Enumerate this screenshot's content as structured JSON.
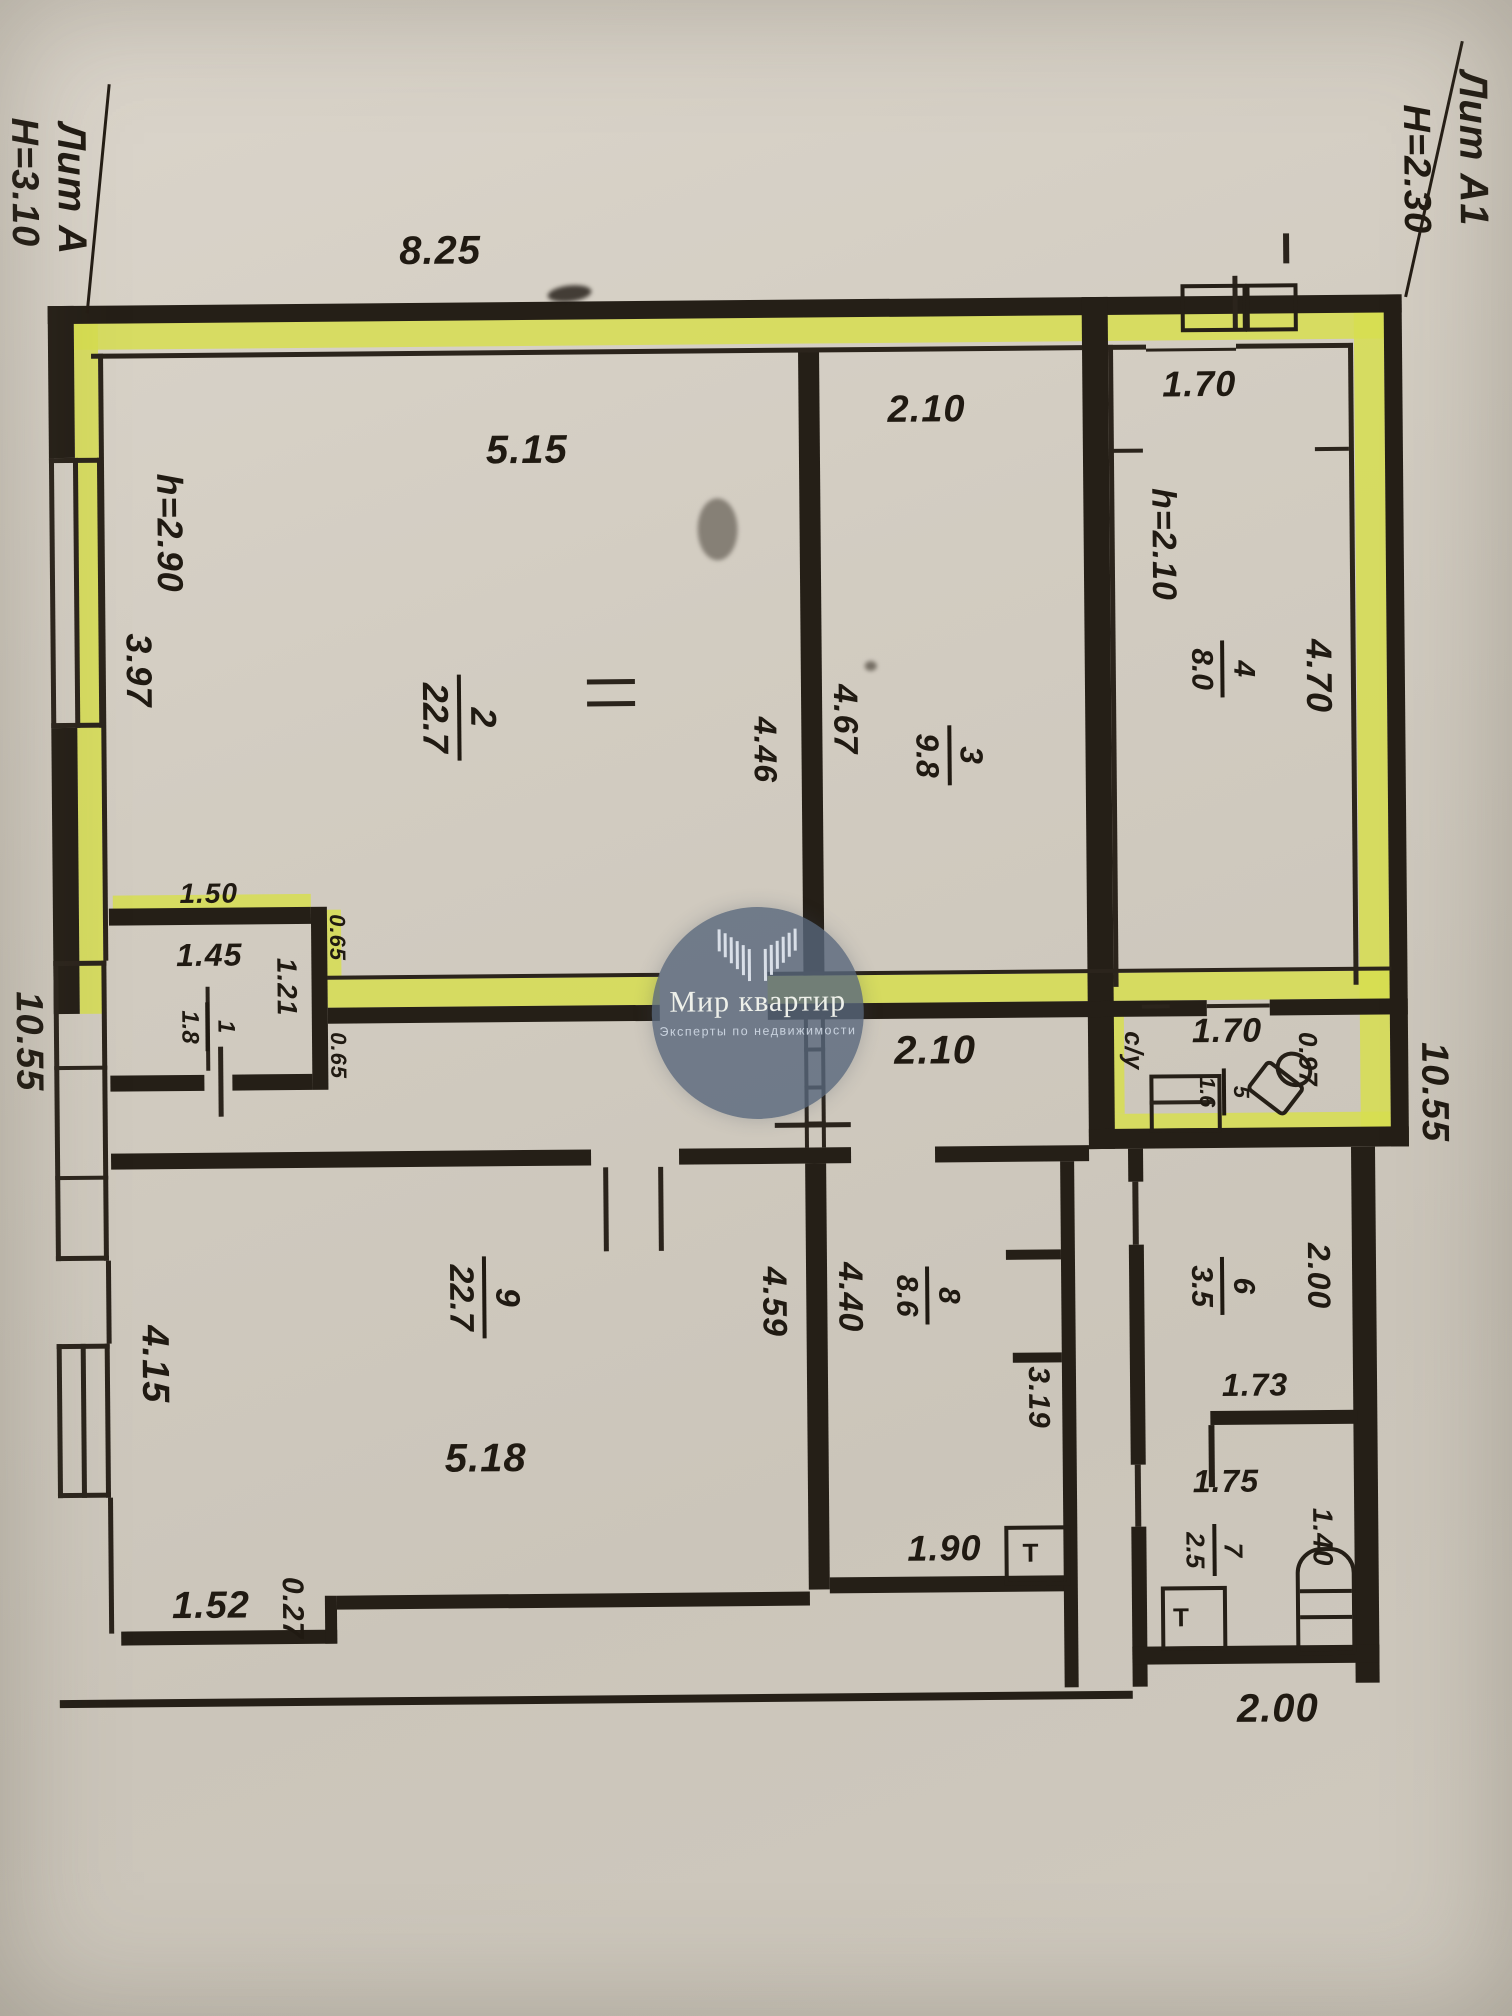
{
  "document": {
    "left_building": {
      "liter": "Лит А",
      "height": "Н=3.10"
    },
    "right_building": {
      "liter": "Лит А1",
      "height": "Н=2.30"
    }
  },
  "watermark": {
    "brand": "Мир квартир",
    "tagline": "Эксперты по недвижимости"
  },
  "colors": {
    "paper": "#d2ccc1",
    "wall": "#251f17",
    "highlight": "#d7de50",
    "watermark_circle": "#586680"
  },
  "rooms": [
    {
      "number": "1",
      "area": "1.8"
    },
    {
      "number": "2",
      "area": "22.7"
    },
    {
      "number": "3",
      "area": "9.8"
    },
    {
      "number": "4",
      "area": "8.0"
    },
    {
      "number": "5",
      "area": "1.6"
    },
    {
      "number": "6",
      "area": "3.5"
    },
    {
      "number": "7",
      "area": "2.5"
    },
    {
      "number": "8",
      "area": "8.6"
    },
    {
      "number": "9",
      "area": "22.7"
    }
  ],
  "labels": {
    "dim_top": "8.25",
    "dim_left": "10.55",
    "dim_right": "10.55",
    "dim_bottom": "2.00",
    "r2_w": "5.15",
    "r2_h": "4.46",
    "r2_ceil": "h=2.90",
    "r2_win": "3.97",
    "r3_w": "2.10",
    "r3_h": "4.67",
    "r4_w": "1.70",
    "r4_ceil": "h=2.10",
    "r4_h": "4.70",
    "r1_top": "1.50",
    "r1_w": "1.45",
    "r1_h": "1.21",
    "r1_r1": "0.65",
    "r1_r2": "0.65",
    "hall_w": "2.10",
    "r5_type": "с/у",
    "r5_w": "1.70",
    "r5_d": "0.97",
    "r6_h": "2.00",
    "r6_w": "1.73",
    "r6_corr": "3.19",
    "r7_w": "1.75",
    "r7_h": "1.40",
    "r8_h": "4.40",
    "r8_w": "1.90",
    "r9_h": "4.59",
    "r9_w": "5.18",
    "r9_win": "4.15",
    "r9_b": "1.52",
    "r9_step": "0.27",
    "t1": "Т",
    "t2": "Т"
  }
}
